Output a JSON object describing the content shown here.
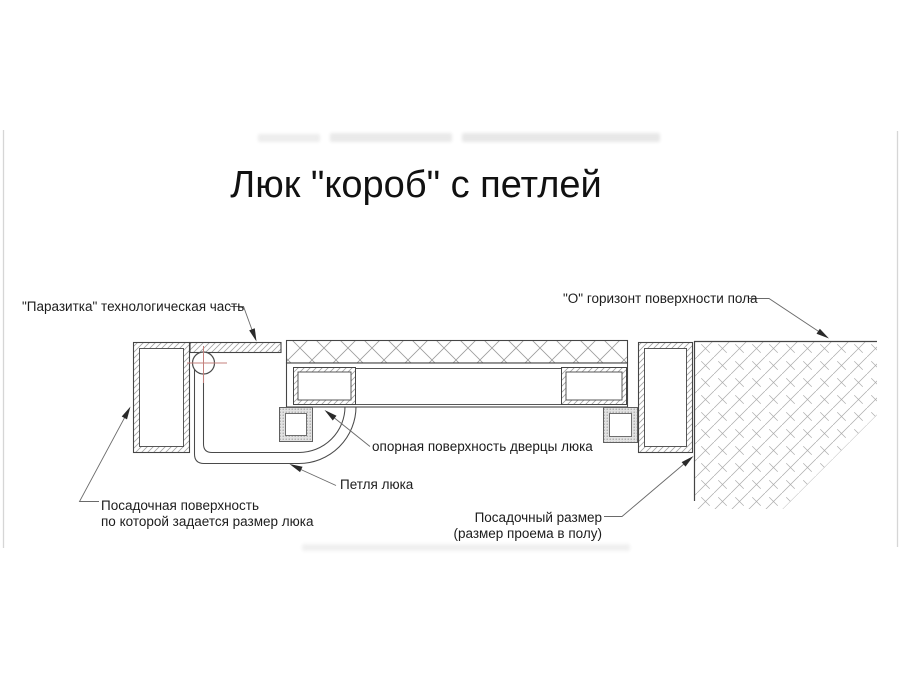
{
  "title": "Люк \"короб\" с петлей",
  "labels": {
    "parasitka": "\"Паразитка\" технологическая часть",
    "floor_horizon": "\"О\" горизонт поверхности пола",
    "door_bearing": "опорная поверхность дверцы люка",
    "hinge": "Петля люка",
    "seating_surface": {
      "line1": "Посадочная поверхность",
      "line2": "по которой задается размер люка"
    },
    "seating_size": {
      "line1": "Посадочный размер",
      "line2": "(размер проема в полу)"
    }
  },
  "colors": {
    "drawing_line": "#454545",
    "hatch_line": "#a3a3a3",
    "centerline_red": "#c4807c",
    "leader_line": "#6a6a6a",
    "image_edge": "#d6d6d6"
  }
}
